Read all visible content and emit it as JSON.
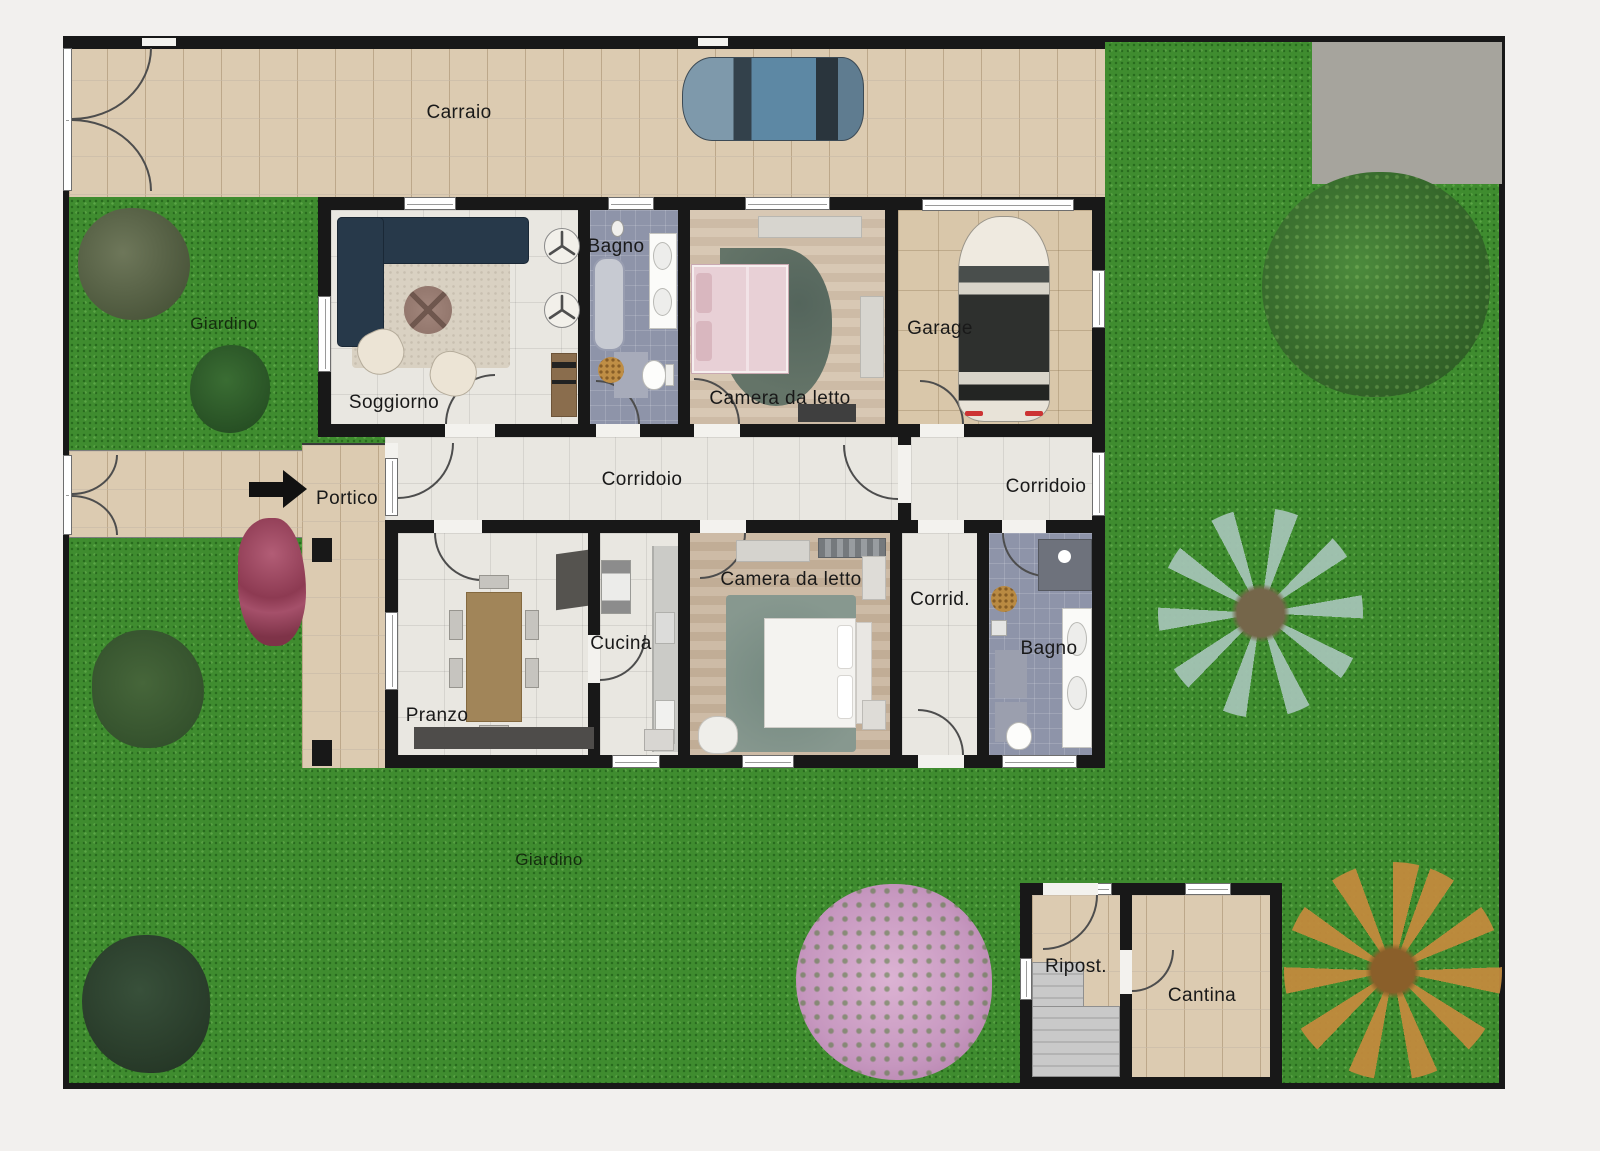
{
  "plan_title": "Planimetria villa con giardino",
  "labels": {
    "carraio": "Carraio",
    "giardino_top": "Giardino",
    "giardino_bottom": "Giardino",
    "soggiorno": "Soggiorno",
    "bagno_top": "Bagno",
    "camera_top": "Camera da letto",
    "garage": "Garage",
    "portico": "Portico",
    "corridoio_main": "Corridoio",
    "corridoio_right": "Corridoio",
    "pranzo": "Pranzo",
    "cucina": "Cucina",
    "camera_bottom": "Camera da letto",
    "corrid_short": "Corrid.",
    "bagno_bottom": "Bagno",
    "ripostiglio": "Ripost.",
    "cantina": "Cantina"
  },
  "palette": {
    "grass": "#3f8c2f",
    "paving": "#dccbb1",
    "interior_floor": "#e9e7e1",
    "bath_tile": "#8e94a9",
    "wood_floor_light": "#d5c5b1",
    "wood_floor_mid": "#c9b7a2",
    "garage_floor": "#d9c7aa",
    "wall": "#181818",
    "window": "#ffffff",
    "concrete_pad": "#a6a49d",
    "sofa_navy": "#27394a",
    "living_rug": "#d9d1c2",
    "car_blue": "#5d88a4",
    "car_white": "#eae5da",
    "bed_pink": "#e8d0d6",
    "rug_teal": "#7e968e",
    "rug_dark_teal": "#5e6e65",
    "dining_table": "#a18559",
    "blossom_tree": "#d7abce",
    "autumn_tree": "#c28a3d",
    "palm_tree": "#a3c3b4"
  }
}
